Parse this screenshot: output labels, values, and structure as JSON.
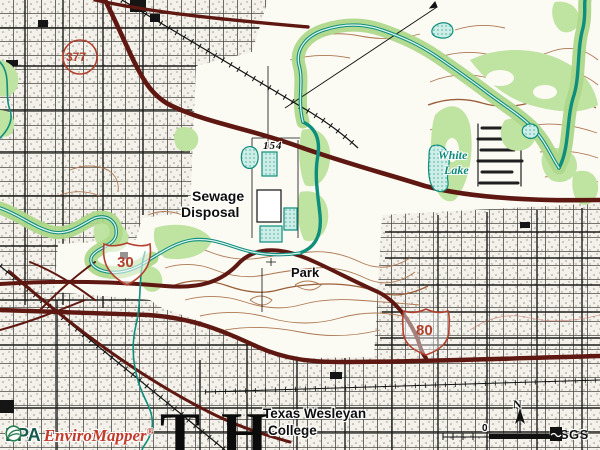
{
  "title": "EPA EnviroMapper topographic map view",
  "map": {
    "place_labels": {
      "elevation_marker": "154",
      "sewage_disposal": [
        "Sewage",
        "Disposal"
      ],
      "white_lake": [
        "White",
        "Lake"
      ],
      "park": "Park",
      "college": [
        "Texas Wesleyan",
        "College"
      ],
      "quad_letters": [
        "T",
        "H"
      ]
    },
    "route_shields": [
      {
        "type": "state-loop",
        "number": "377"
      },
      {
        "type": "interstate",
        "number": "30"
      },
      {
        "type": "us-route",
        "number": "80"
      }
    ],
    "compass_label": "N",
    "scale_zero_label": "0",
    "colors": {
      "highway_dark_red": "#5e1811",
      "route_red": "#b3402e",
      "water_teal": "#0e8e7d",
      "vegetation_green": "#bfe3a0",
      "contour_brown": "#ad7852",
      "urban_tint": "#f3f1ea"
    }
  },
  "branding": {
    "epa_text": "EPA",
    "enviromapper_text": "EnviroMapper",
    "registered_mark": "®",
    "usgs_text": "USGS"
  }
}
